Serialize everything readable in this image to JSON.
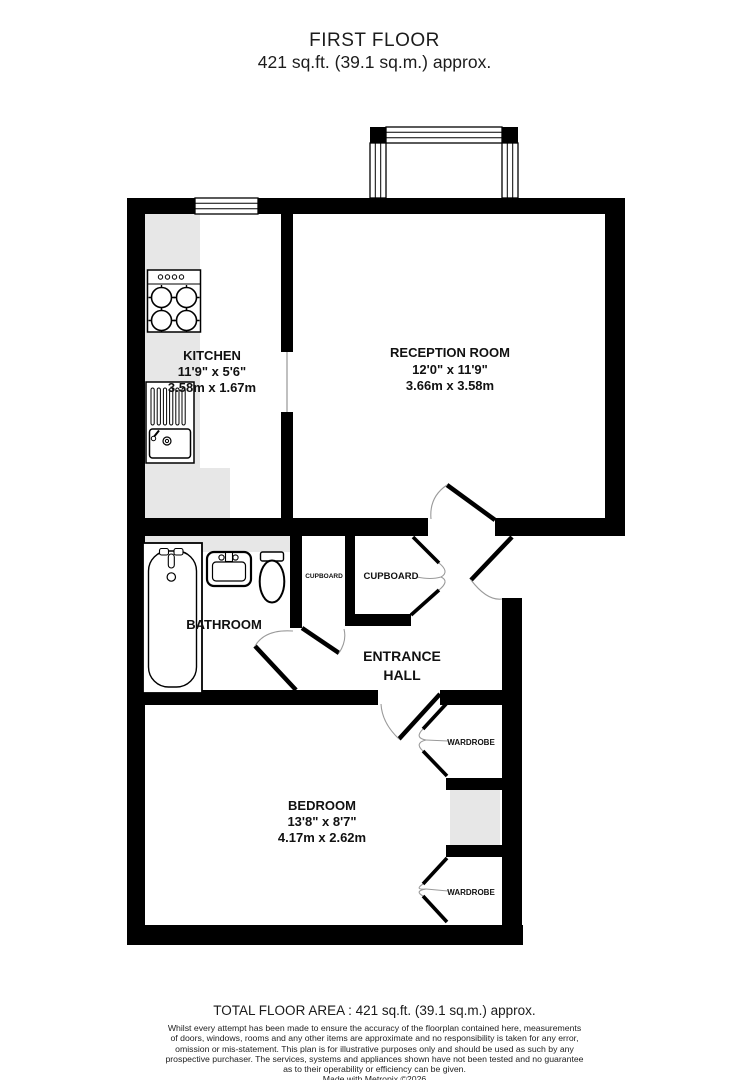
{
  "title": {
    "line1": "FIRST FLOOR",
    "line2": "421 sq.ft. (39.1 sq.m.) approx."
  },
  "rooms": {
    "kitchen": {
      "name": "KITCHEN",
      "imperial": "11'9\" x 5'6\"",
      "metric": "3.58m x 1.67m"
    },
    "reception": {
      "name": "RECEPTION ROOM",
      "imperial": "12'0\" x 11'9\"",
      "metric": "3.66m x 3.58m"
    },
    "bathroom": {
      "name": "BATHROOM"
    },
    "entrance_hall": {
      "line1": "ENTRANCE",
      "line2": "HALL"
    },
    "bedroom": {
      "name": "BEDROOM",
      "imperial": "13'8\" x 8'7\"",
      "metric": "4.17m x 2.62m"
    },
    "cupboard_small": {
      "name": "CUPBOARD"
    },
    "cupboard_large": {
      "name": "CUPBOARD"
    },
    "wardrobe_top": {
      "name": "WARDROBE"
    },
    "wardrobe_bottom": {
      "name": "WARDROBE"
    }
  },
  "footer": {
    "total_area": "TOTAL FLOOR AREA : 421 sq.ft. (39.1 sq.m.) approx.",
    "disclaimer_lines": [
      "Whilst every attempt has been made to ensure the accuracy of the floorplan contained here, measurements",
      "of doors, windows, rooms and any other items are approximate and no responsibility is taken for any error,",
      "omission or mis-statement. This plan is for illustrative purposes only and should be used as such by any",
      "prospective purchaser. The services, systems and appliances shown have not been tested and no guarantee",
      "as to their operability or efficiency can be given."
    ],
    "credit": "Made with Metropix ©2026"
  },
  "colors": {
    "wall": "#000000",
    "shading": "#e7e7e7",
    "door_arc": "#9a9a9a",
    "background": "#ffffff"
  }
}
